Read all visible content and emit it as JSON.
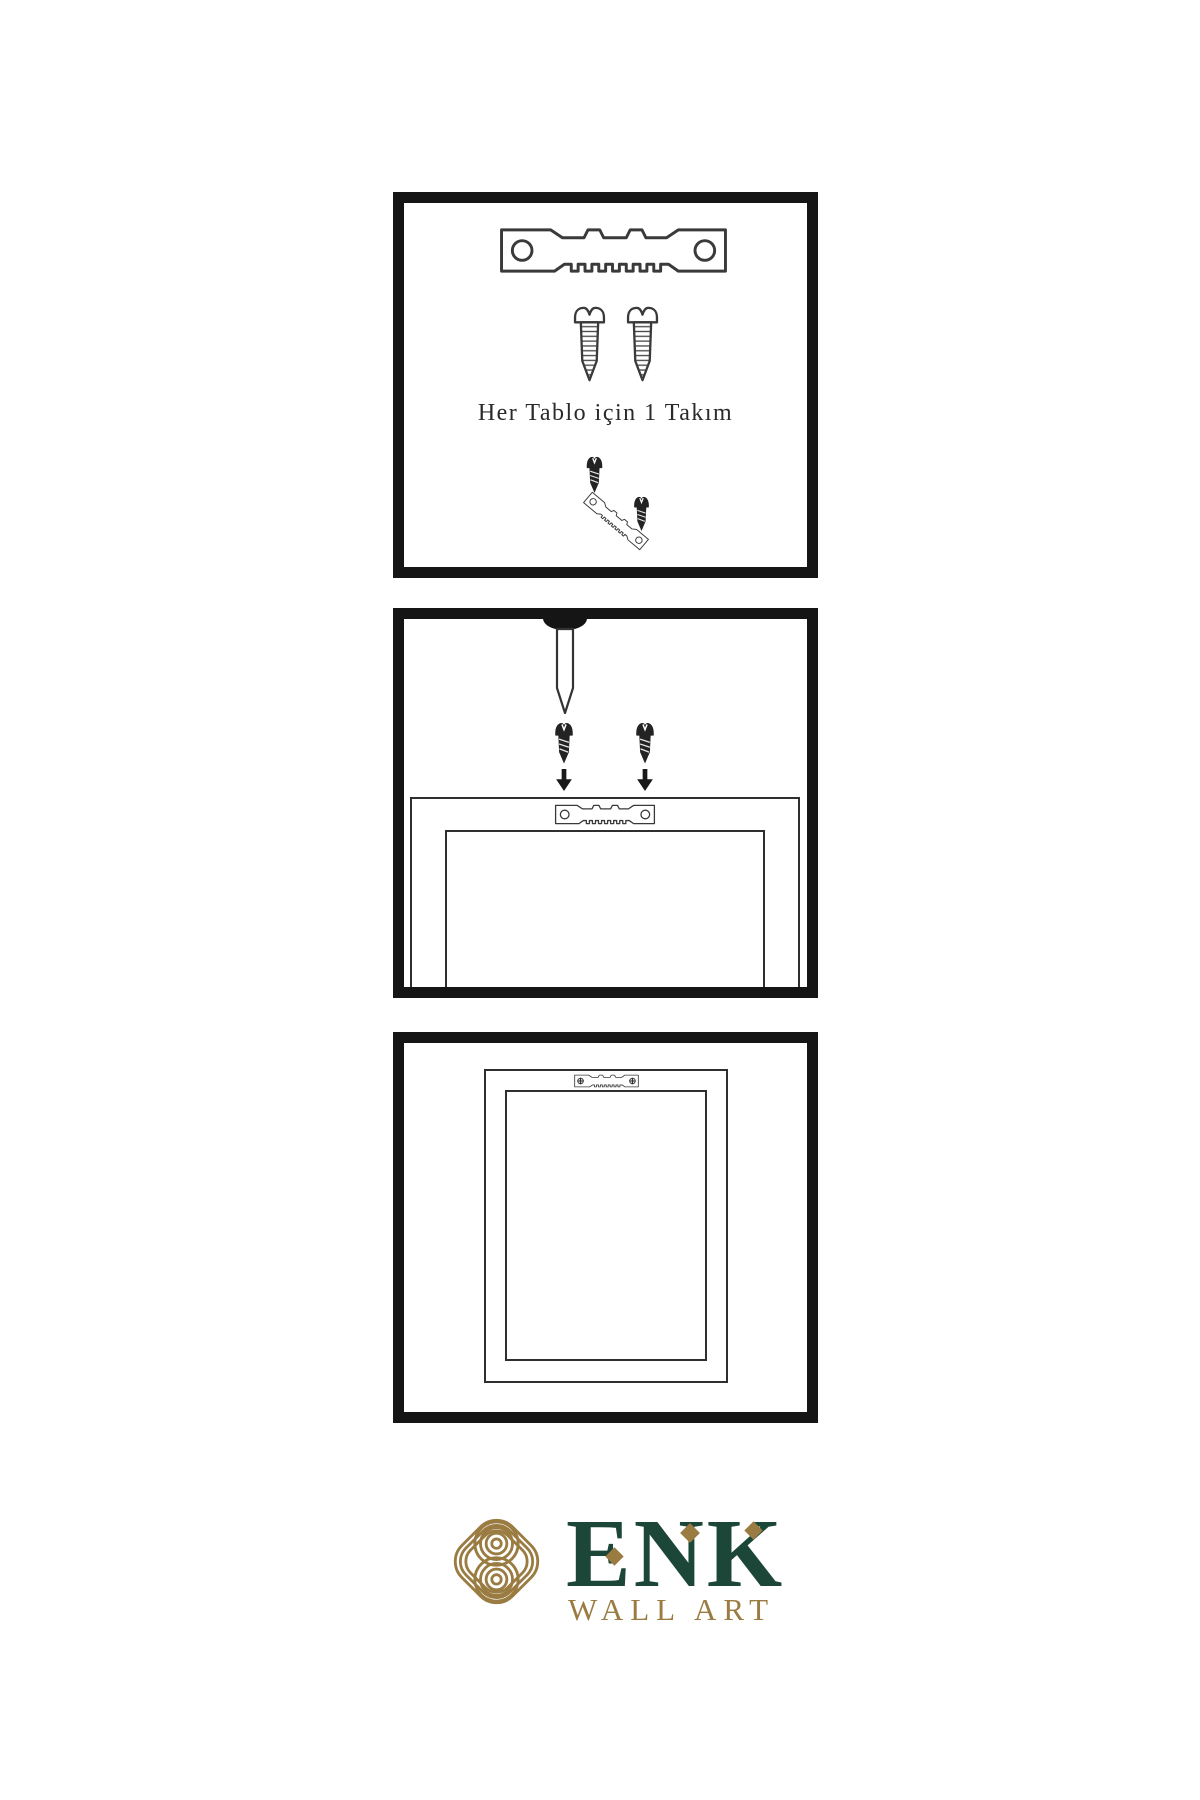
{
  "step1": {
    "caption": "Her Tablo için 1 Takım"
  },
  "brand": {
    "name": "ENK",
    "subtitle": "WALL ART"
  },
  "colors": {
    "background": "#ffffff",
    "panel_border": "#151515",
    "line_art": "#3a3a3a",
    "dark_metal": "#232323",
    "brand_green": "#1B4638",
    "brand_gold": "#9A7C42"
  }
}
